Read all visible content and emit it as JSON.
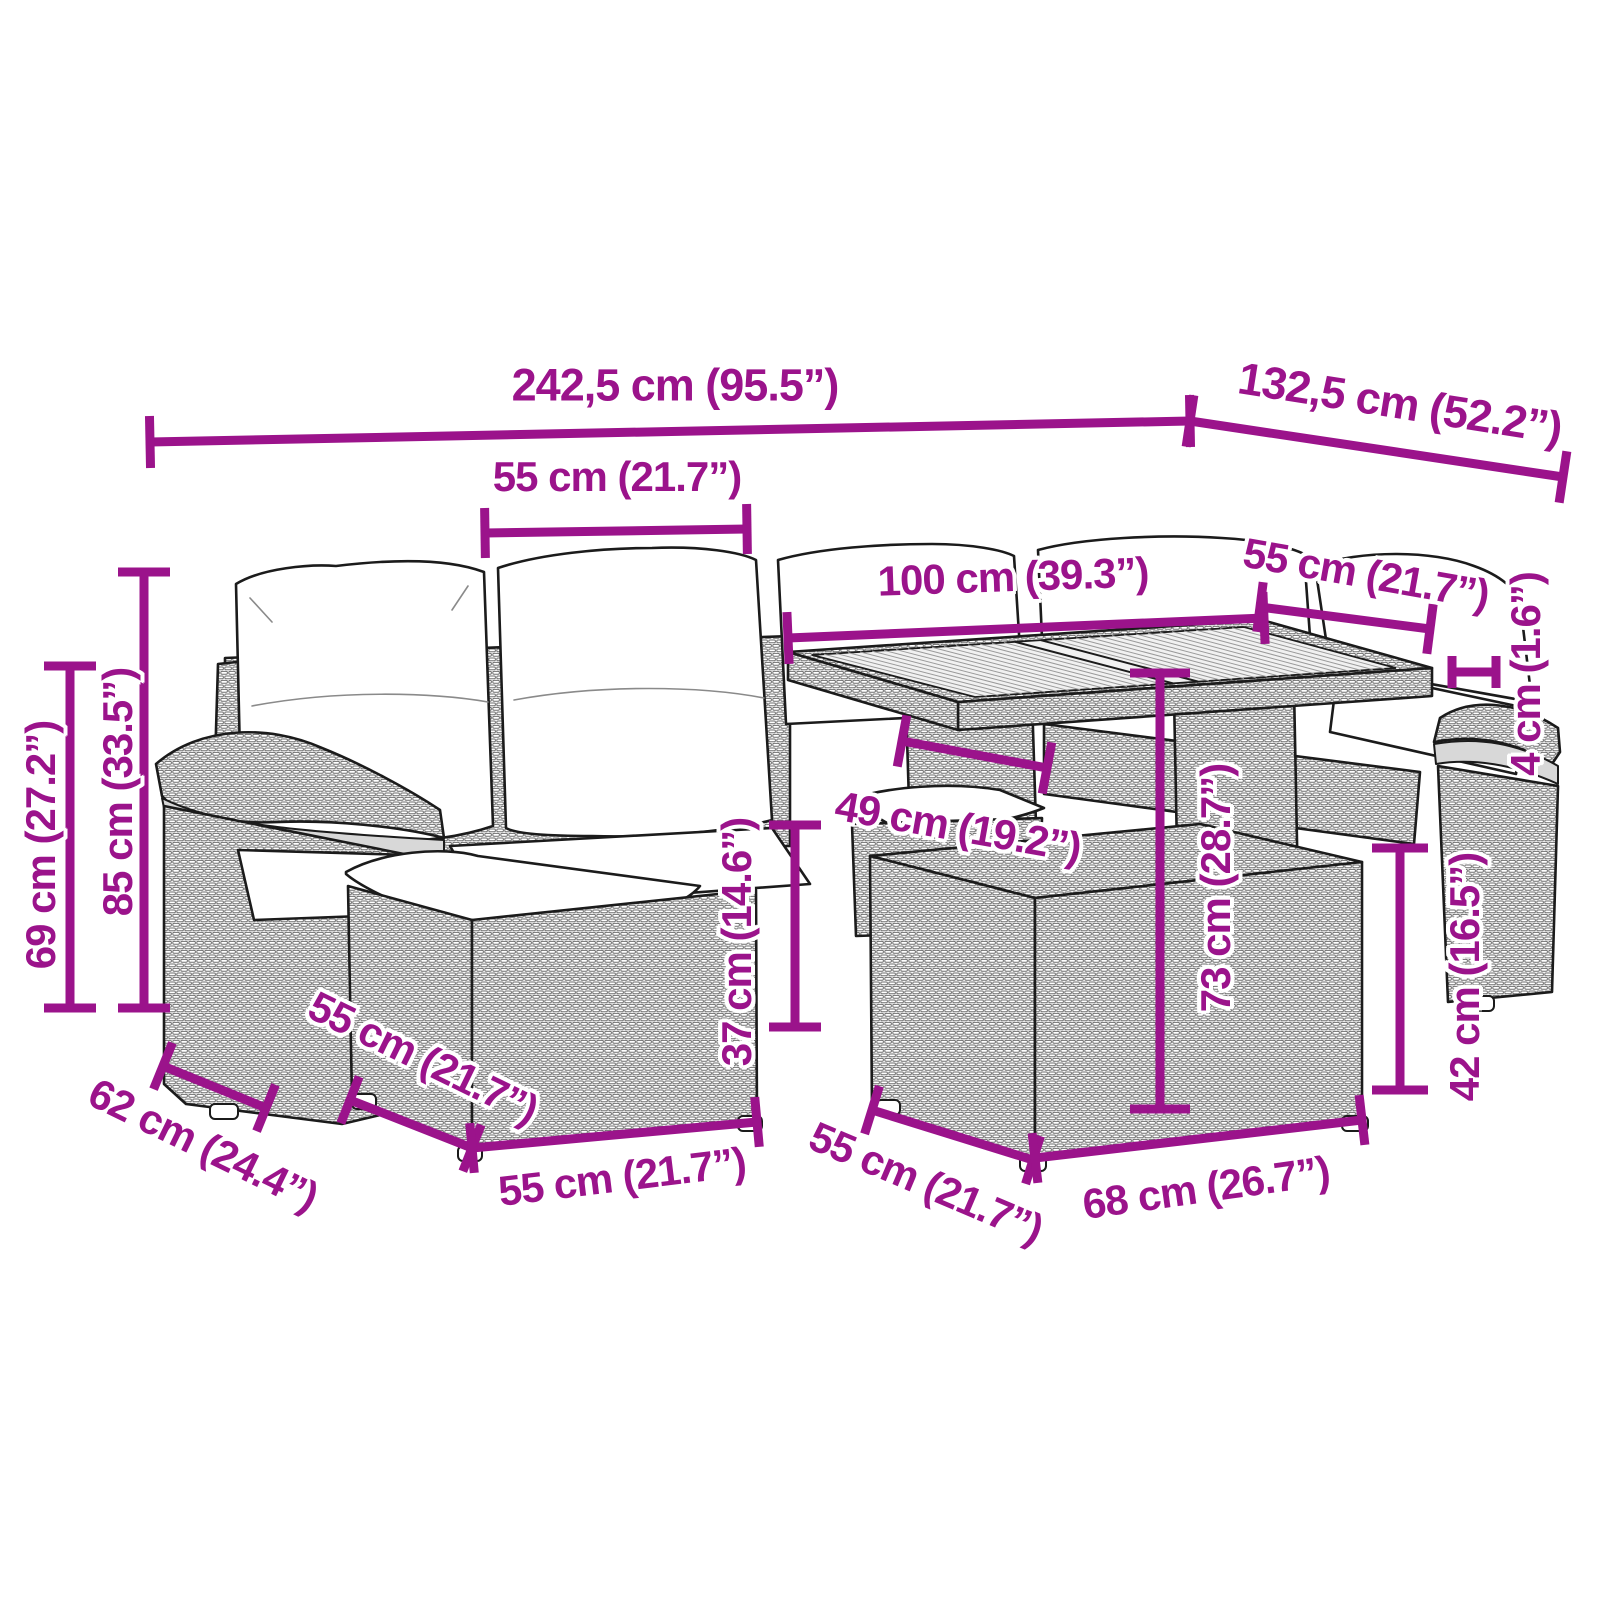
{
  "diagram": {
    "type": "product-dimension-diagram",
    "subject": "garden-furniture-set-with-table",
    "background_color": "#ffffff",
    "accent_color": "#9B138B",
    "line_art_color": "#1b1b1b"
  },
  "dimensions": {
    "overall_width": "242,5 cm (95.5”)",
    "overall_depth": "132,5 cm (52.2”)",
    "back_cushion_width": "55 cm (21.7”)",
    "table_length": "100 cm (39.3”)",
    "table_depth": "55 cm (21.7”)",
    "tabletop_thickness": "4 cm (1.6”)",
    "armrest_height": "69 cm (27.2”)",
    "backrest_height": "85 cm (33.5”)",
    "armrest_depth": "62 cm (24.4”)",
    "ottoman_depth": "55 cm (21.7”)",
    "ottoman_width": "55 cm (21.7”)",
    "seat_height": "37 cm (14.6”)",
    "table_clearance": "49 cm (19.2”)",
    "table_height": "73 cm (28.7”)",
    "stool_height": "42 cm (16.5”)",
    "stool_depth": "55 cm (21.7”)",
    "stool_width": "68 cm (26.7”)"
  }
}
